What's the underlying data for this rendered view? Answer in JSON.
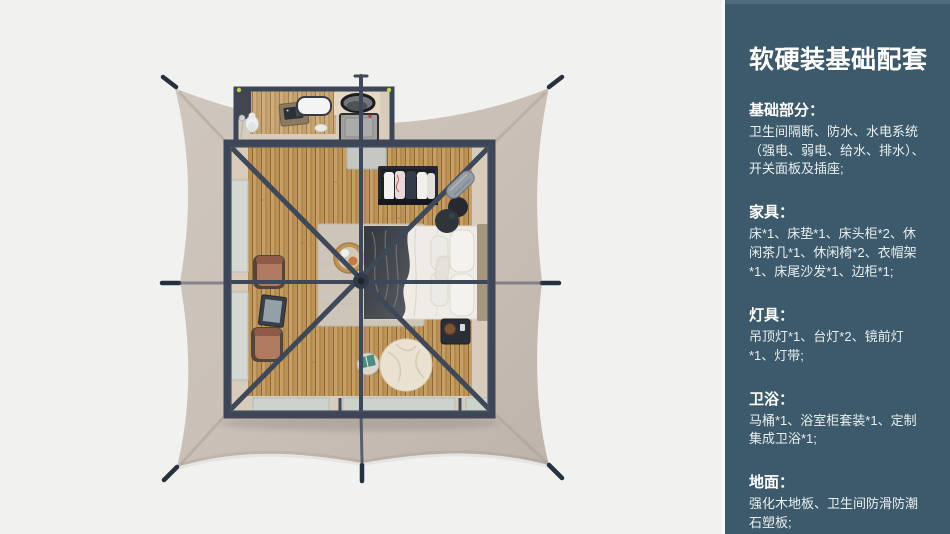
{
  "panel": {
    "title": "软硬装基础配套",
    "sections": [
      {
        "heading": "基础部分：",
        "body": "卫生间隔断、防水、水电系统（强电、弱电、给水、排水）、开关面板及插座;"
      },
      {
        "heading": "家具：",
        "body": "床*1、床垫*1、床头柜*2、休闲茶几*1、休闲椅*2、衣帽架*1、床尾沙发*1、边柜*1;"
      },
      {
        "heading": "灯具：",
        "body": "吊顶灯*1、台灯*2、镜前灯*1、灯带;"
      },
      {
        "heading": "卫浴：",
        "body": "马桶*1、浴室柜套装*1、定制集成卫浴*1;"
      },
      {
        "heading": "地面：",
        "body": "强化木地板、卫生间防滑防潮石塑板;"
      }
    ]
  },
  "colors": {
    "page_bg": "#f1f1f0",
    "panel_bg": "#3c5a6b",
    "panel_text": "#e9eef1",
    "canopy": "#c9bfb6",
    "frame": "#3d4656",
    "wood_floor": "#c79f63",
    "floor_border": "#d7cbbc",
    "rug": "#cdc5b7",
    "bedding": "#efece7",
    "chair": "#b07a61",
    "pouf": "#eae1d0"
  }
}
